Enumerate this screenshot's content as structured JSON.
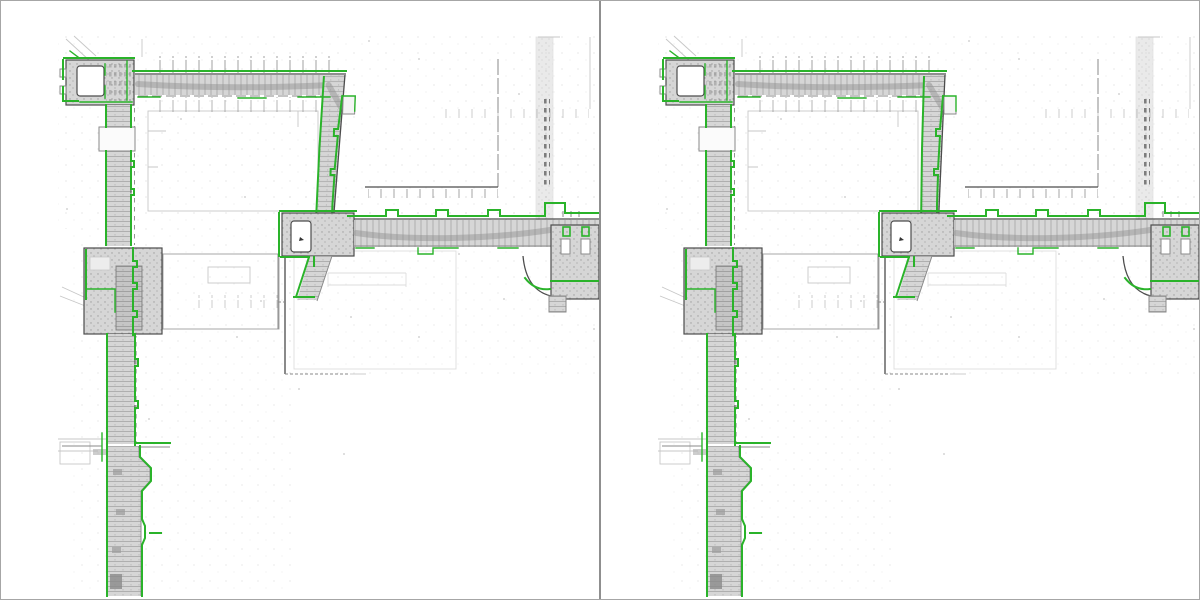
{
  "figure": {
    "kind": "side-by-side floor-plan / point-cloud map comparison",
    "panel_count": 2
  },
  "panels": [
    {
      "name": "map-left",
      "corridor_lean_deg": -2
    },
    {
      "name": "map-right",
      "corridor_lean_deg": 0
    }
  ],
  "colors": {
    "overlay_green": "#2ab32a",
    "wall_dark": "#4c4c4c",
    "wall_mid": "#8a8a8a",
    "wall_light": "#c7c7c7",
    "pc_light": "#d6d6d6",
    "pc_mid": "#9e9e9e",
    "frame": "#a6a6a6",
    "divider": "#8f8f8f",
    "bg": "#ffffff"
  }
}
